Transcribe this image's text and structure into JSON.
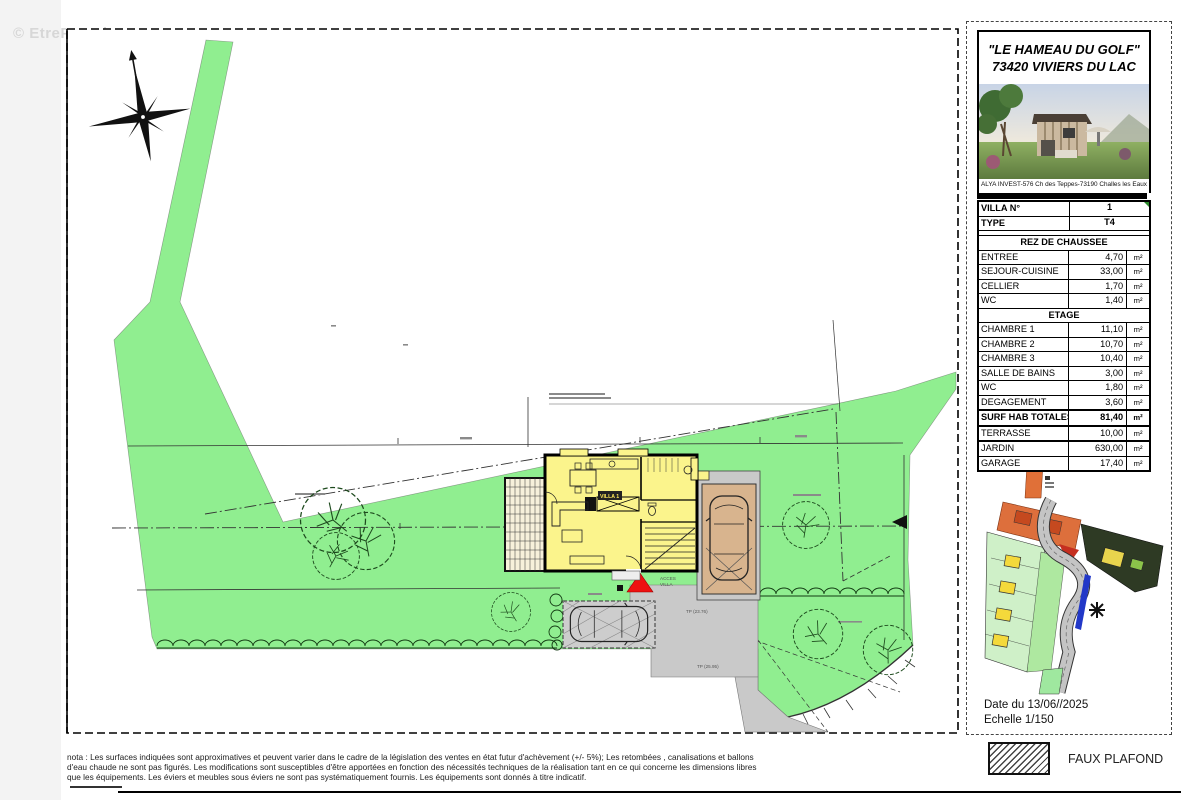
{
  "watermark": "© EtreProprio.com",
  "colors": {
    "site_green": "#90EE90",
    "house_yellow": "#FBF48C",
    "terrace_cream": "#F7F1DB",
    "garage_tan": "#D8B48E",
    "paving_gray": "#C9C9C9",
    "access_red": "#EE1111",
    "marker_green": "#2E8B2E"
  },
  "panel": {
    "title_line1": "\"LE HAMEAU DU GOLF\"",
    "title_line2": "73420 VIVIERS DU LAC",
    "photo_caption": "ALYA INVEST-576 Ch des Teppes-73190 Challes les Eaux",
    "date_line": "Date du 13/06//2025",
    "scale_line": "Echelle 1/150",
    "table": {
      "rows": [
        {
          "label": "VILLA N°",
          "value": "1",
          "unit": ""
        },
        {
          "label": "TYPE",
          "value": "T4",
          "unit": ""
        },
        {
          "label": "REZ DE CHAUSSEE"
        },
        {
          "label": "ENTREE",
          "value": "4,70",
          "unit": "m²"
        },
        {
          "label": "SEJOUR-CUISINE",
          "value": "33,00",
          "unit": "m²"
        },
        {
          "label": "CELLIER",
          "value": "1,70",
          "unit": "m²"
        },
        {
          "label": "WC",
          "value": "1,40",
          "unit": "m²"
        },
        {
          "label": "ETAGE"
        },
        {
          "label": "CHAMBRE 1",
          "value": "11,10",
          "unit": "m²"
        },
        {
          "label": "CHAMBRE 2",
          "value": "10,70",
          "unit": "m²"
        },
        {
          "label": "CHAMBRE 3",
          "value": "10,40",
          "unit": "m²"
        },
        {
          "label": "SALLE DE BAINS",
          "value": "3,00",
          "unit": "m²"
        },
        {
          "label": "WC",
          "value": "1,80",
          "unit": "m²"
        },
        {
          "label": "DEGAGEMENT",
          "value": "3,60",
          "unit": "m²"
        },
        {
          "label": "SURF HAB TOTALES",
          "value": "81,40",
          "unit": "m²"
        },
        {
          "label": "TERRASSE",
          "value": "10,00",
          "unit": "m²"
        },
        {
          "label": "JARDIN",
          "value": "630,00",
          "unit": "m²"
        },
        {
          "label": "GARAGE",
          "value": "17,40",
          "unit": "m²"
        }
      ]
    }
  },
  "legend": {
    "faux_plafond": "FAUX PLAFOND"
  },
  "plan": {
    "acces_label_1": "ACCES",
    "acces_label_2": "VILLA",
    "villa_box_label": "VILLA 1",
    "tp_label_1": "TP (23.76)",
    "tp_label_2": "TP (25.95)"
  },
  "nota": "nota : Les surfaces indiquées sont approximatives et peuvent varier dans le cadre de la législation des ventes en état futur d'achèvement (+/- 5%); Les retombées , canalisations et ballons d'eau chaude ne sont pas figurés. Les modifications sont susceptibles d'être apportées en fonction des nécessités techniques de la réalisation tant en ce qui concerne les dimensions libres que les équipements. Les éviers et meubles sous éviers ne sont pas systématiquement fournis. Les équipements sont donnés à titre indicatif."
}
